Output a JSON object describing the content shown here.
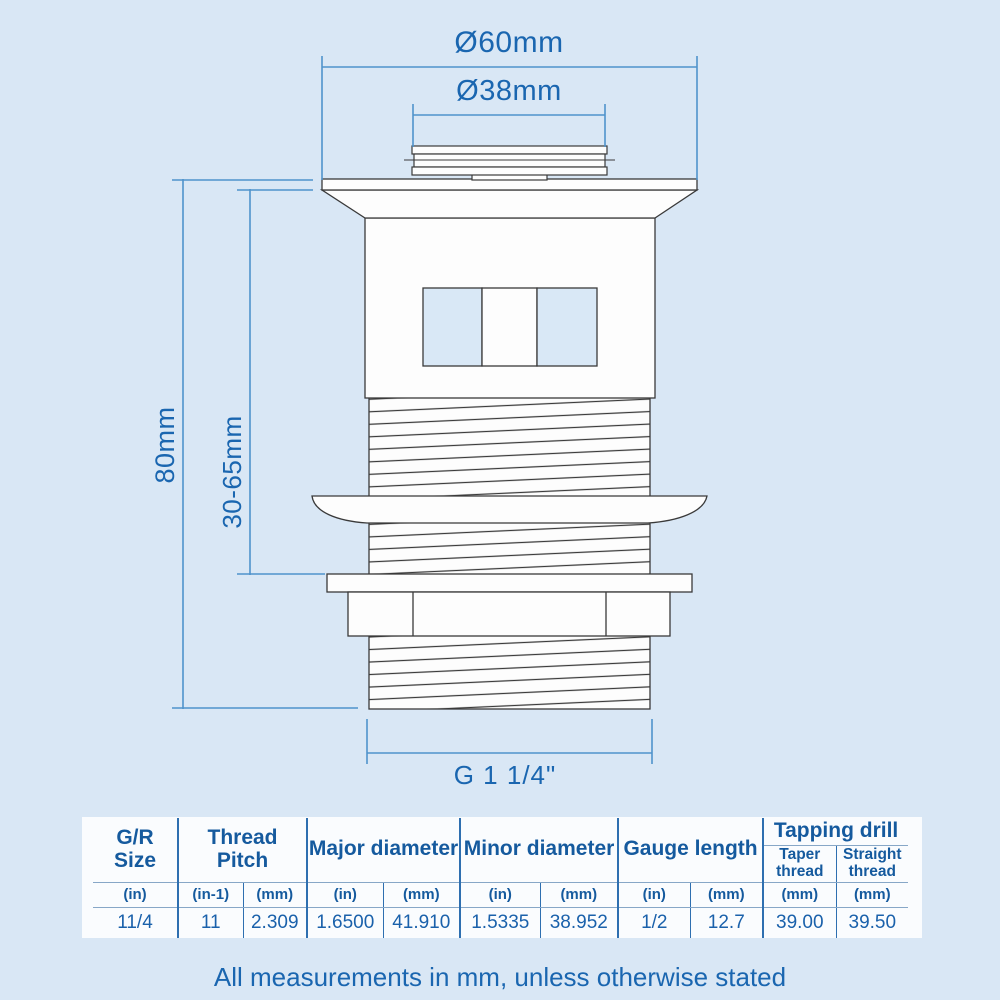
{
  "diagram": {
    "dim_outer_diameter": "Ø60mm",
    "dim_plug_diameter": "Ø38mm",
    "dim_overall_height": "80mm",
    "dim_clamp_range": "30-65mm",
    "dim_thread_size": "G 1 1/4\""
  },
  "table": {
    "groups": [
      {
        "label": "G/R Size"
      },
      {
        "label": "Thread Pitch"
      },
      {
        "label": "Major diameter"
      },
      {
        "label": "Minor diameter"
      },
      {
        "label": "Gauge length"
      },
      {
        "label": "Tapping drill",
        "subs": [
          "Taper thread",
          "Straight thread"
        ]
      }
    ],
    "units": [
      "(in)",
      "(in-1)",
      "(mm)",
      "(in)",
      "(mm)",
      "(in)",
      "(mm)",
      "(in)",
      "(mm)",
      "(mm)",
      "(mm)"
    ],
    "values": [
      "11/4",
      "11",
      "2.309",
      "1.6500",
      "41.910",
      "1.5335",
      "38.952",
      "1/2",
      "12.7",
      "39.00",
      "39.50"
    ]
  },
  "footer": {
    "note": "All measurements in mm, unless otherwise stated"
  },
  "colors": {
    "background": "#d9e7f5",
    "text_blue": "#1a66b0",
    "dimension_line_blue": "#4f93cb",
    "table_line_blue": "#2e6fb0",
    "drawing_outline": "#3a3a3a",
    "panel_white": "#fafcfe"
  }
}
